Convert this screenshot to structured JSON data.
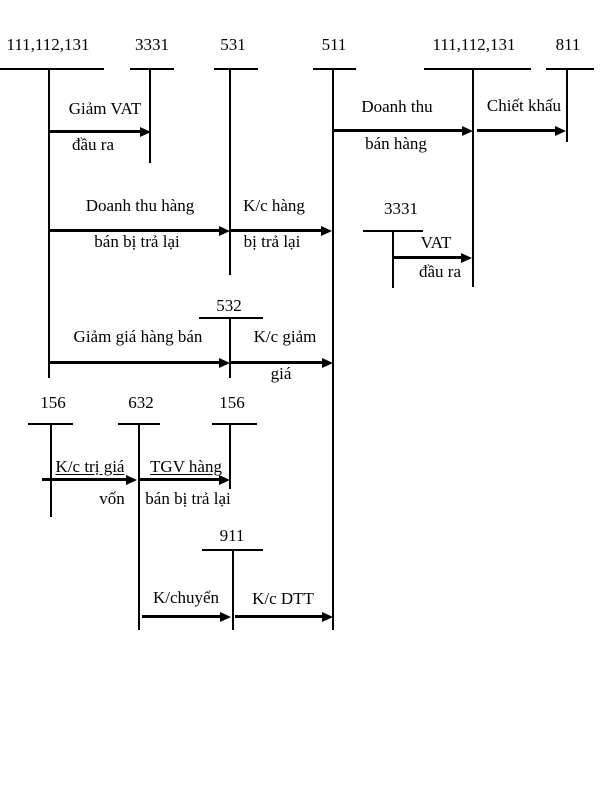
{
  "colors": {
    "ink": "#000000",
    "paper": "#ffffff"
  },
  "accounts": {
    "top": [
      "111,112,131",
      "3331",
      "531",
      "511",
      "111,112,131",
      "811"
    ],
    "middle": [
      "3331",
      "532"
    ],
    "lower": [
      "156",
      "632",
      "156"
    ],
    "bottom": [
      "911"
    ]
  },
  "flows": {
    "giam_vat": {
      "above": "Giảm VAT",
      "below": "đầu ra"
    },
    "doanh_thu_ban_hang": {
      "above": "Doanh thu",
      "below": "bán hàng"
    },
    "chiet_khau": {
      "above": "Chiết khấu"
    },
    "hang_ban_tra_lai": {
      "above": "Doanh thu hàng",
      "below": "bán bị trả lại"
    },
    "kc_hang_tra_lai": {
      "above": "K/c hàng",
      "below": "bị trả lại"
    },
    "vat_dau_ra": {
      "above": "VAT",
      "below": "đầu ra"
    },
    "giam_gia_hang_ban": {
      "above": "Giảm giá hàng bán"
    },
    "kc_giam_gia": {
      "above": "K/c giảm",
      "below": "giá"
    },
    "kc_tri_gia_von": {
      "above": "K/c trị giá",
      "below": "vốn"
    },
    "tgv_hang_tra_lai": {
      "above": "TGV hàng",
      "below": "bán bị trả lại"
    },
    "k_chuyen": {
      "above": "K/chuyển"
    },
    "kc_dtt": {
      "above": "K/c DTT"
    }
  }
}
